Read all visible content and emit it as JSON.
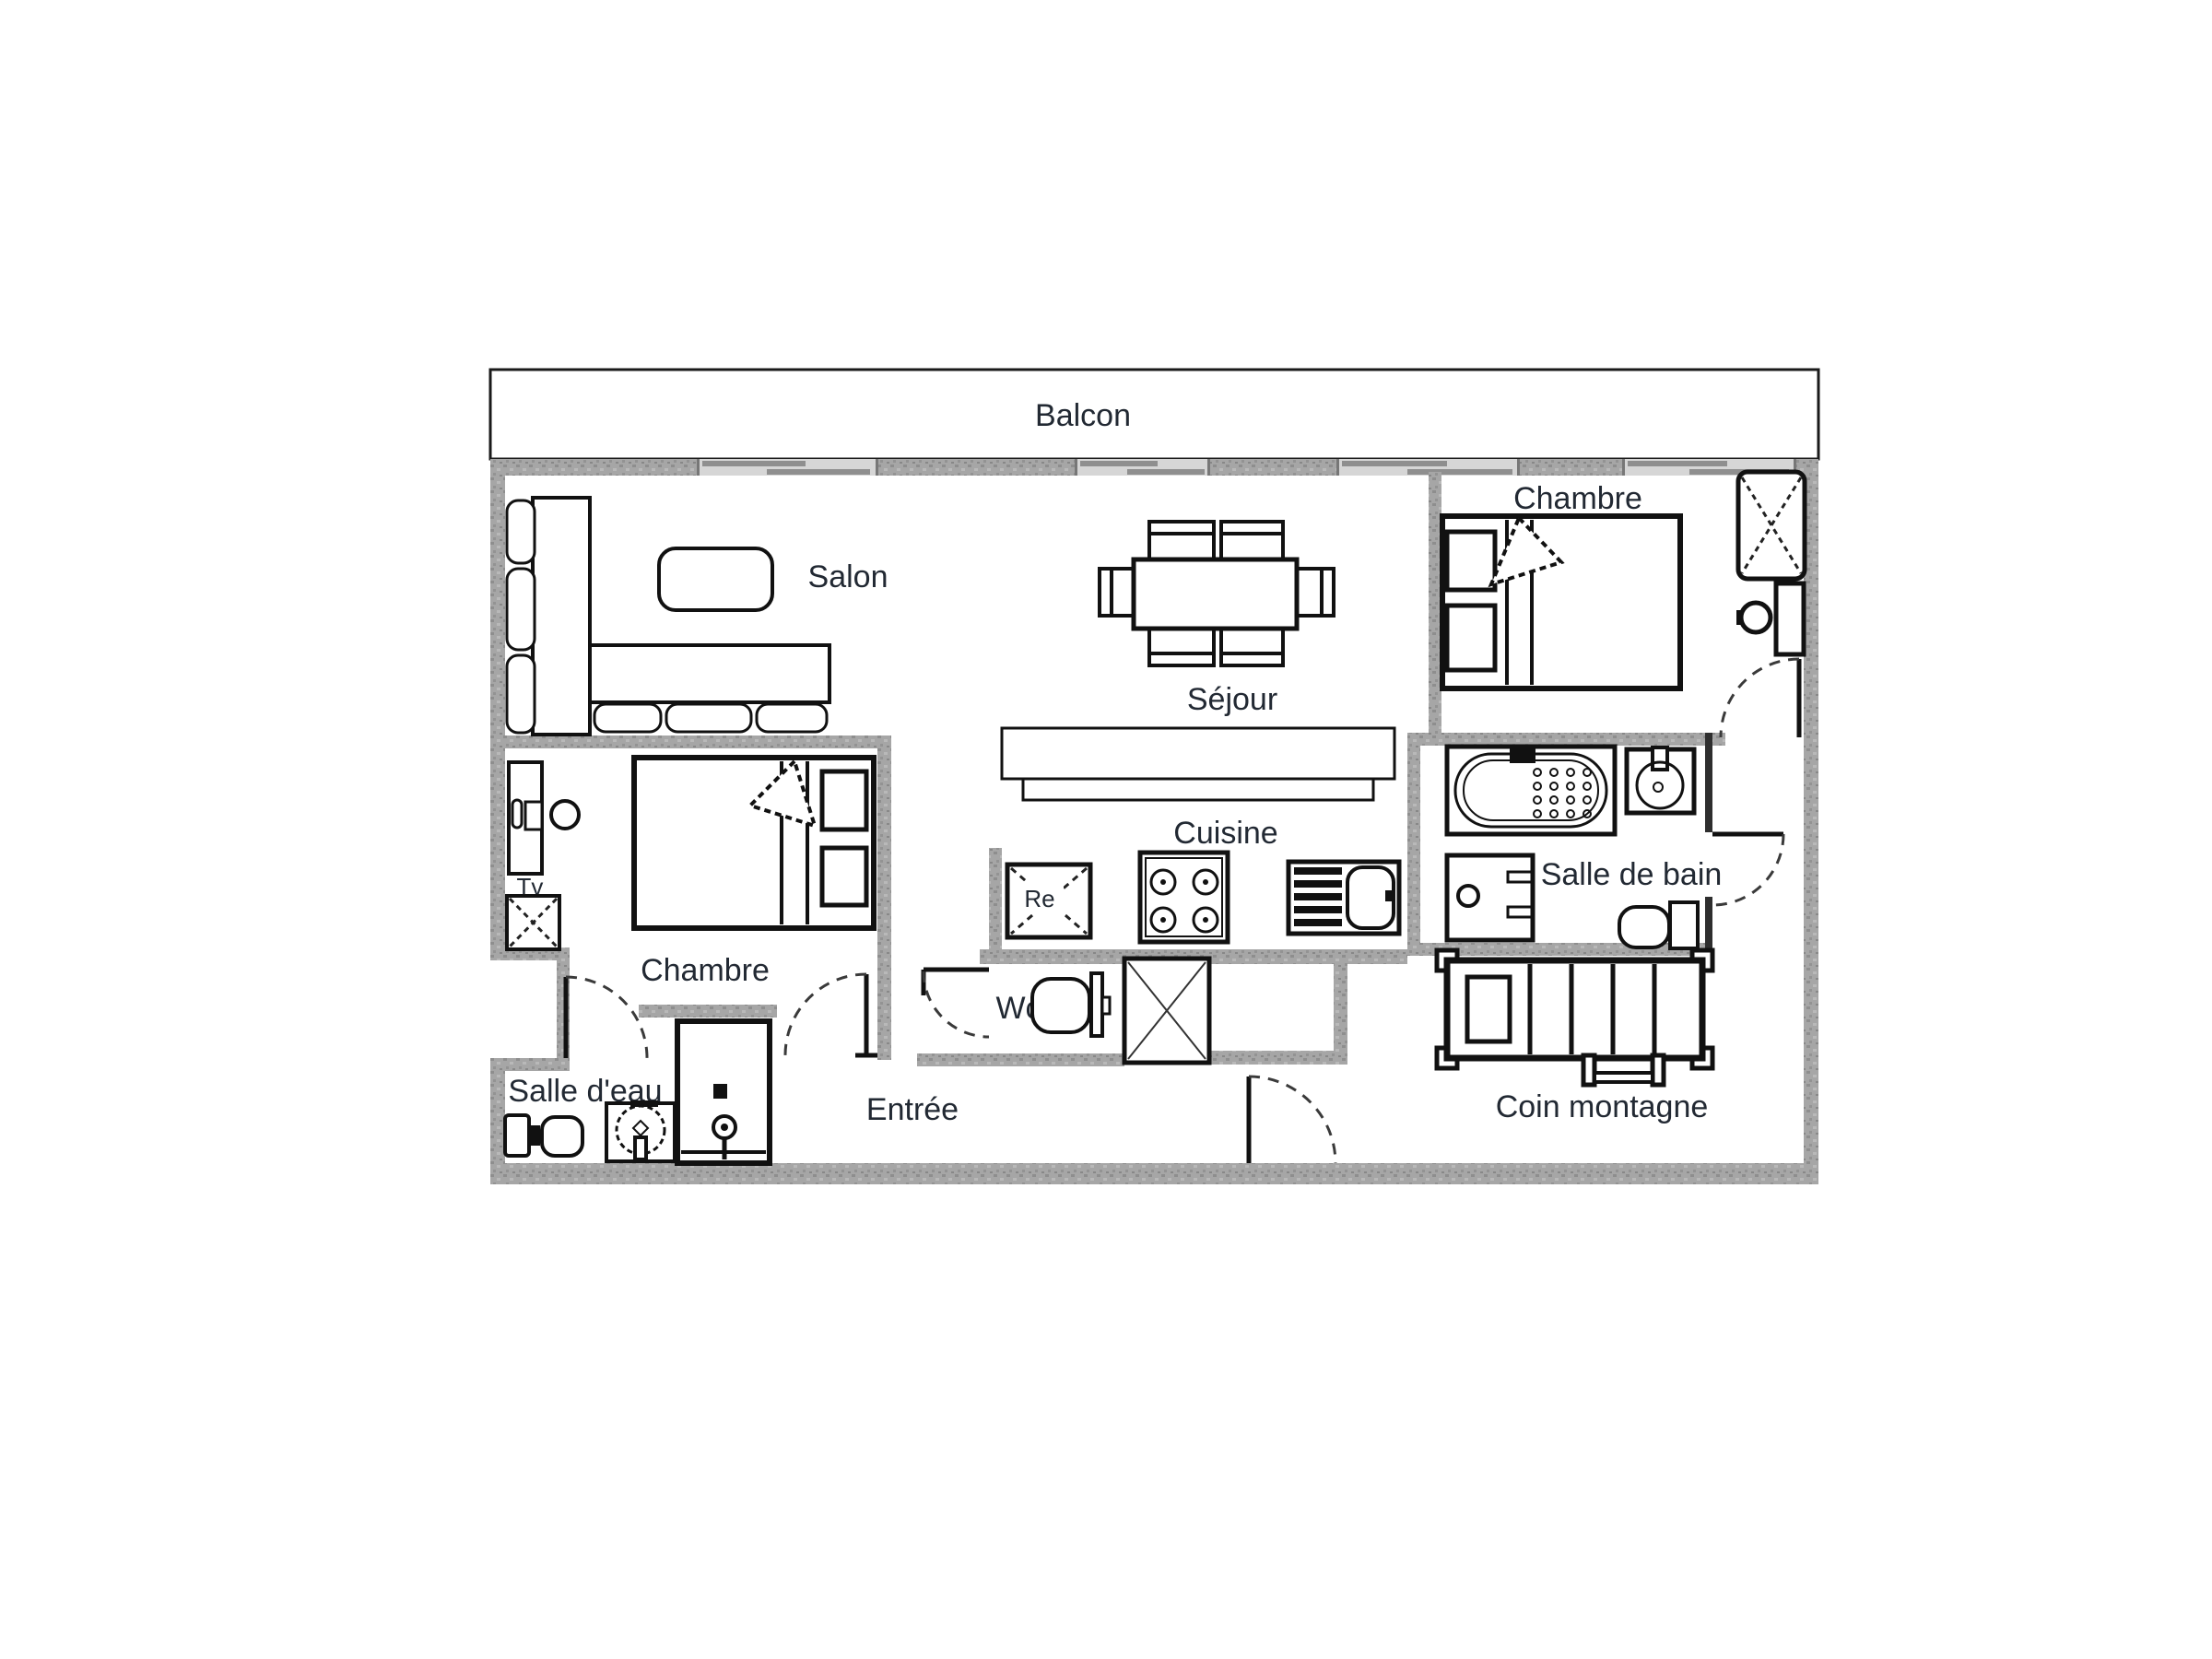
{
  "plan": {
    "rooms": {
      "balcon": "Balcon",
      "salon": "Salon",
      "sejour": "Séjour",
      "cuisine": "Cuisine",
      "chambre_nord": "Chambre",
      "chambre_sud": "Chambre",
      "salle_de_bain": "Salle de bain",
      "salle_d_eau": "Salle d'eau",
      "wc": "Wc",
      "entree": "Entrée",
      "coin_montagne": "Coin montagne"
    },
    "annotations": {
      "tv": "Tv",
      "fridge": "Re"
    },
    "colors": {
      "wall": "#a6a6a6",
      "line": "#111111",
      "label": "#222933",
      "window_band": "#d6d6d6",
      "window_bar": "#8f8f8f",
      "background": "#ffffff"
    },
    "furniture": [
      "corner-sofa",
      "coffee-table",
      "dining-table",
      "dining-chair",
      "kitchen-counter",
      "refrigerator",
      "stove",
      "kitchen-sink",
      "double-bed",
      "wardrobe",
      "nightstand",
      "stool",
      "desk",
      "bathtub",
      "washbasin",
      "washing-machine",
      "toilet",
      "shower",
      "bunk-bed",
      "ladder",
      "closet"
    ]
  }
}
